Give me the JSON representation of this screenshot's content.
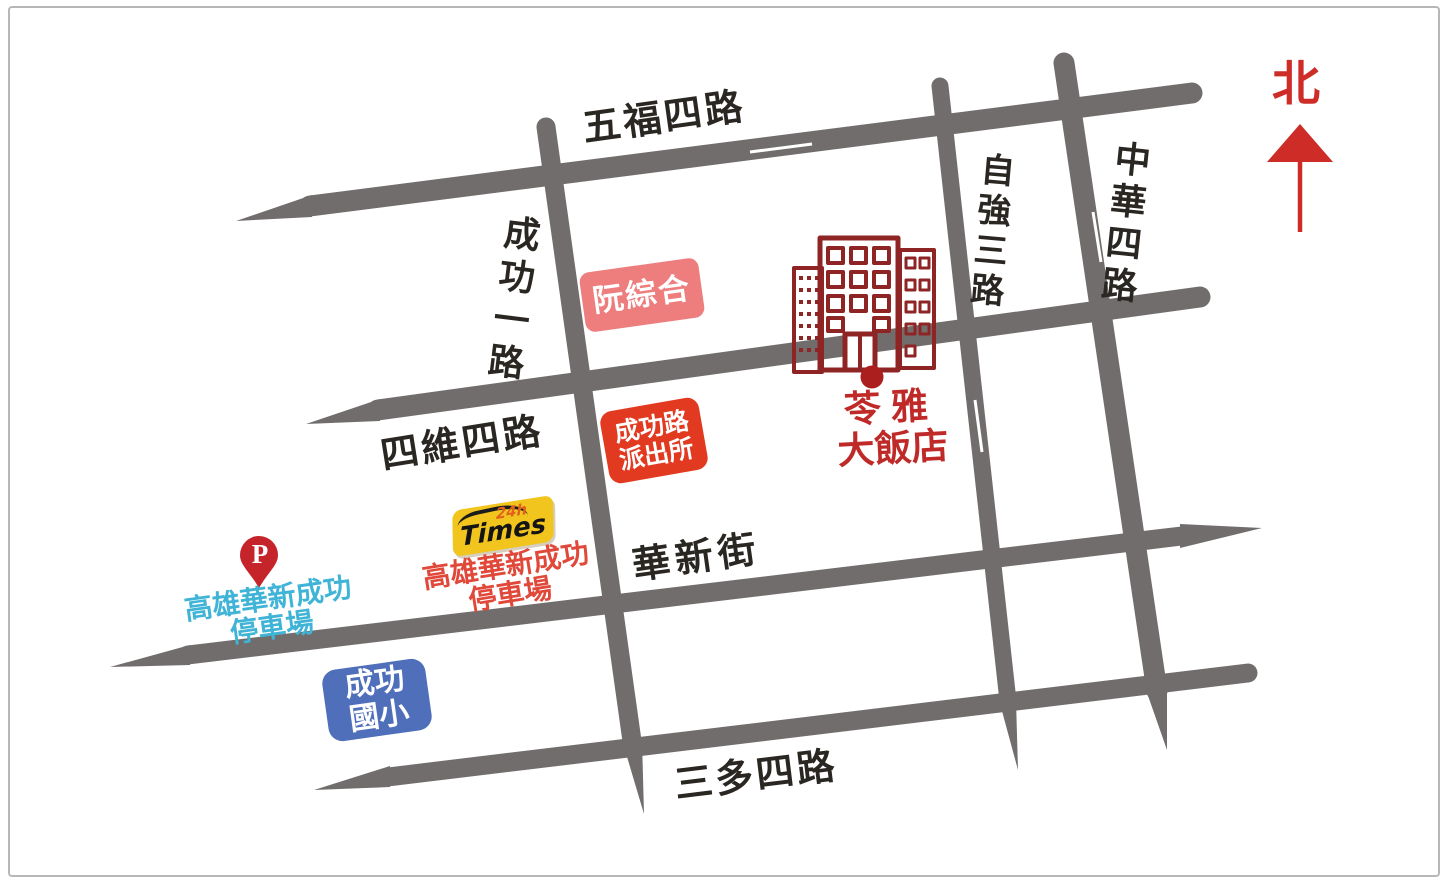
{
  "frame": {
    "background": "#ffffff",
    "border_color": "#b9b6b6"
  },
  "compass": {
    "label": "北",
    "color": "#cd2c27"
  },
  "roads": {
    "color": "#716d6d",
    "label_color": "#2a2723",
    "wufu4": {
      "name": "五福四路",
      "orientation": "horizontal"
    },
    "siwei4": {
      "name": "四維四路",
      "orientation": "horizontal"
    },
    "huaxin": {
      "name": "華新街",
      "orientation": "horizontal"
    },
    "sanduo4": {
      "name": "三多四路",
      "orientation": "horizontal"
    },
    "chenggong1": {
      "name": "成功一路",
      "orientation": "vertical"
    },
    "ziqiang3": {
      "name": "自強三路",
      "orientation": "vertical"
    },
    "zhonghua4": {
      "name": "中華四路",
      "orientation": "vertical"
    }
  },
  "pois": {
    "hospital": {
      "label": "阮綜合",
      "bg": "#ee7d7d"
    },
    "police": {
      "line1": "成功路",
      "line2": "派出所",
      "bg": "#e23a20"
    },
    "hotel": {
      "line1": "苓雅",
      "line2": "大飯店",
      "text_color": "#bf2a28",
      "building_color": "#8e2424",
      "dot_color": "#ac1f1f"
    },
    "times": {
      "brand": "Times",
      "hours": "24h",
      "line1": "高雄華新成功",
      "line2": "停車場",
      "bg": "#f1c51d",
      "text_color": "#e0483a"
    },
    "parking_pin": {
      "letter": "P",
      "line1": "高雄華新成功",
      "line2": "停車場",
      "pin_color": "#c5242b",
      "text_color": "#3fb4d6"
    },
    "school": {
      "line1": "成功",
      "line2": "國小",
      "bg": "#4f6fba"
    }
  },
  "icons": {
    "north_arrow": "north-up-arrow",
    "hotel_building": "building-outline",
    "hotel_dot": "location-dot",
    "parking_pin": "map-pin"
  }
}
